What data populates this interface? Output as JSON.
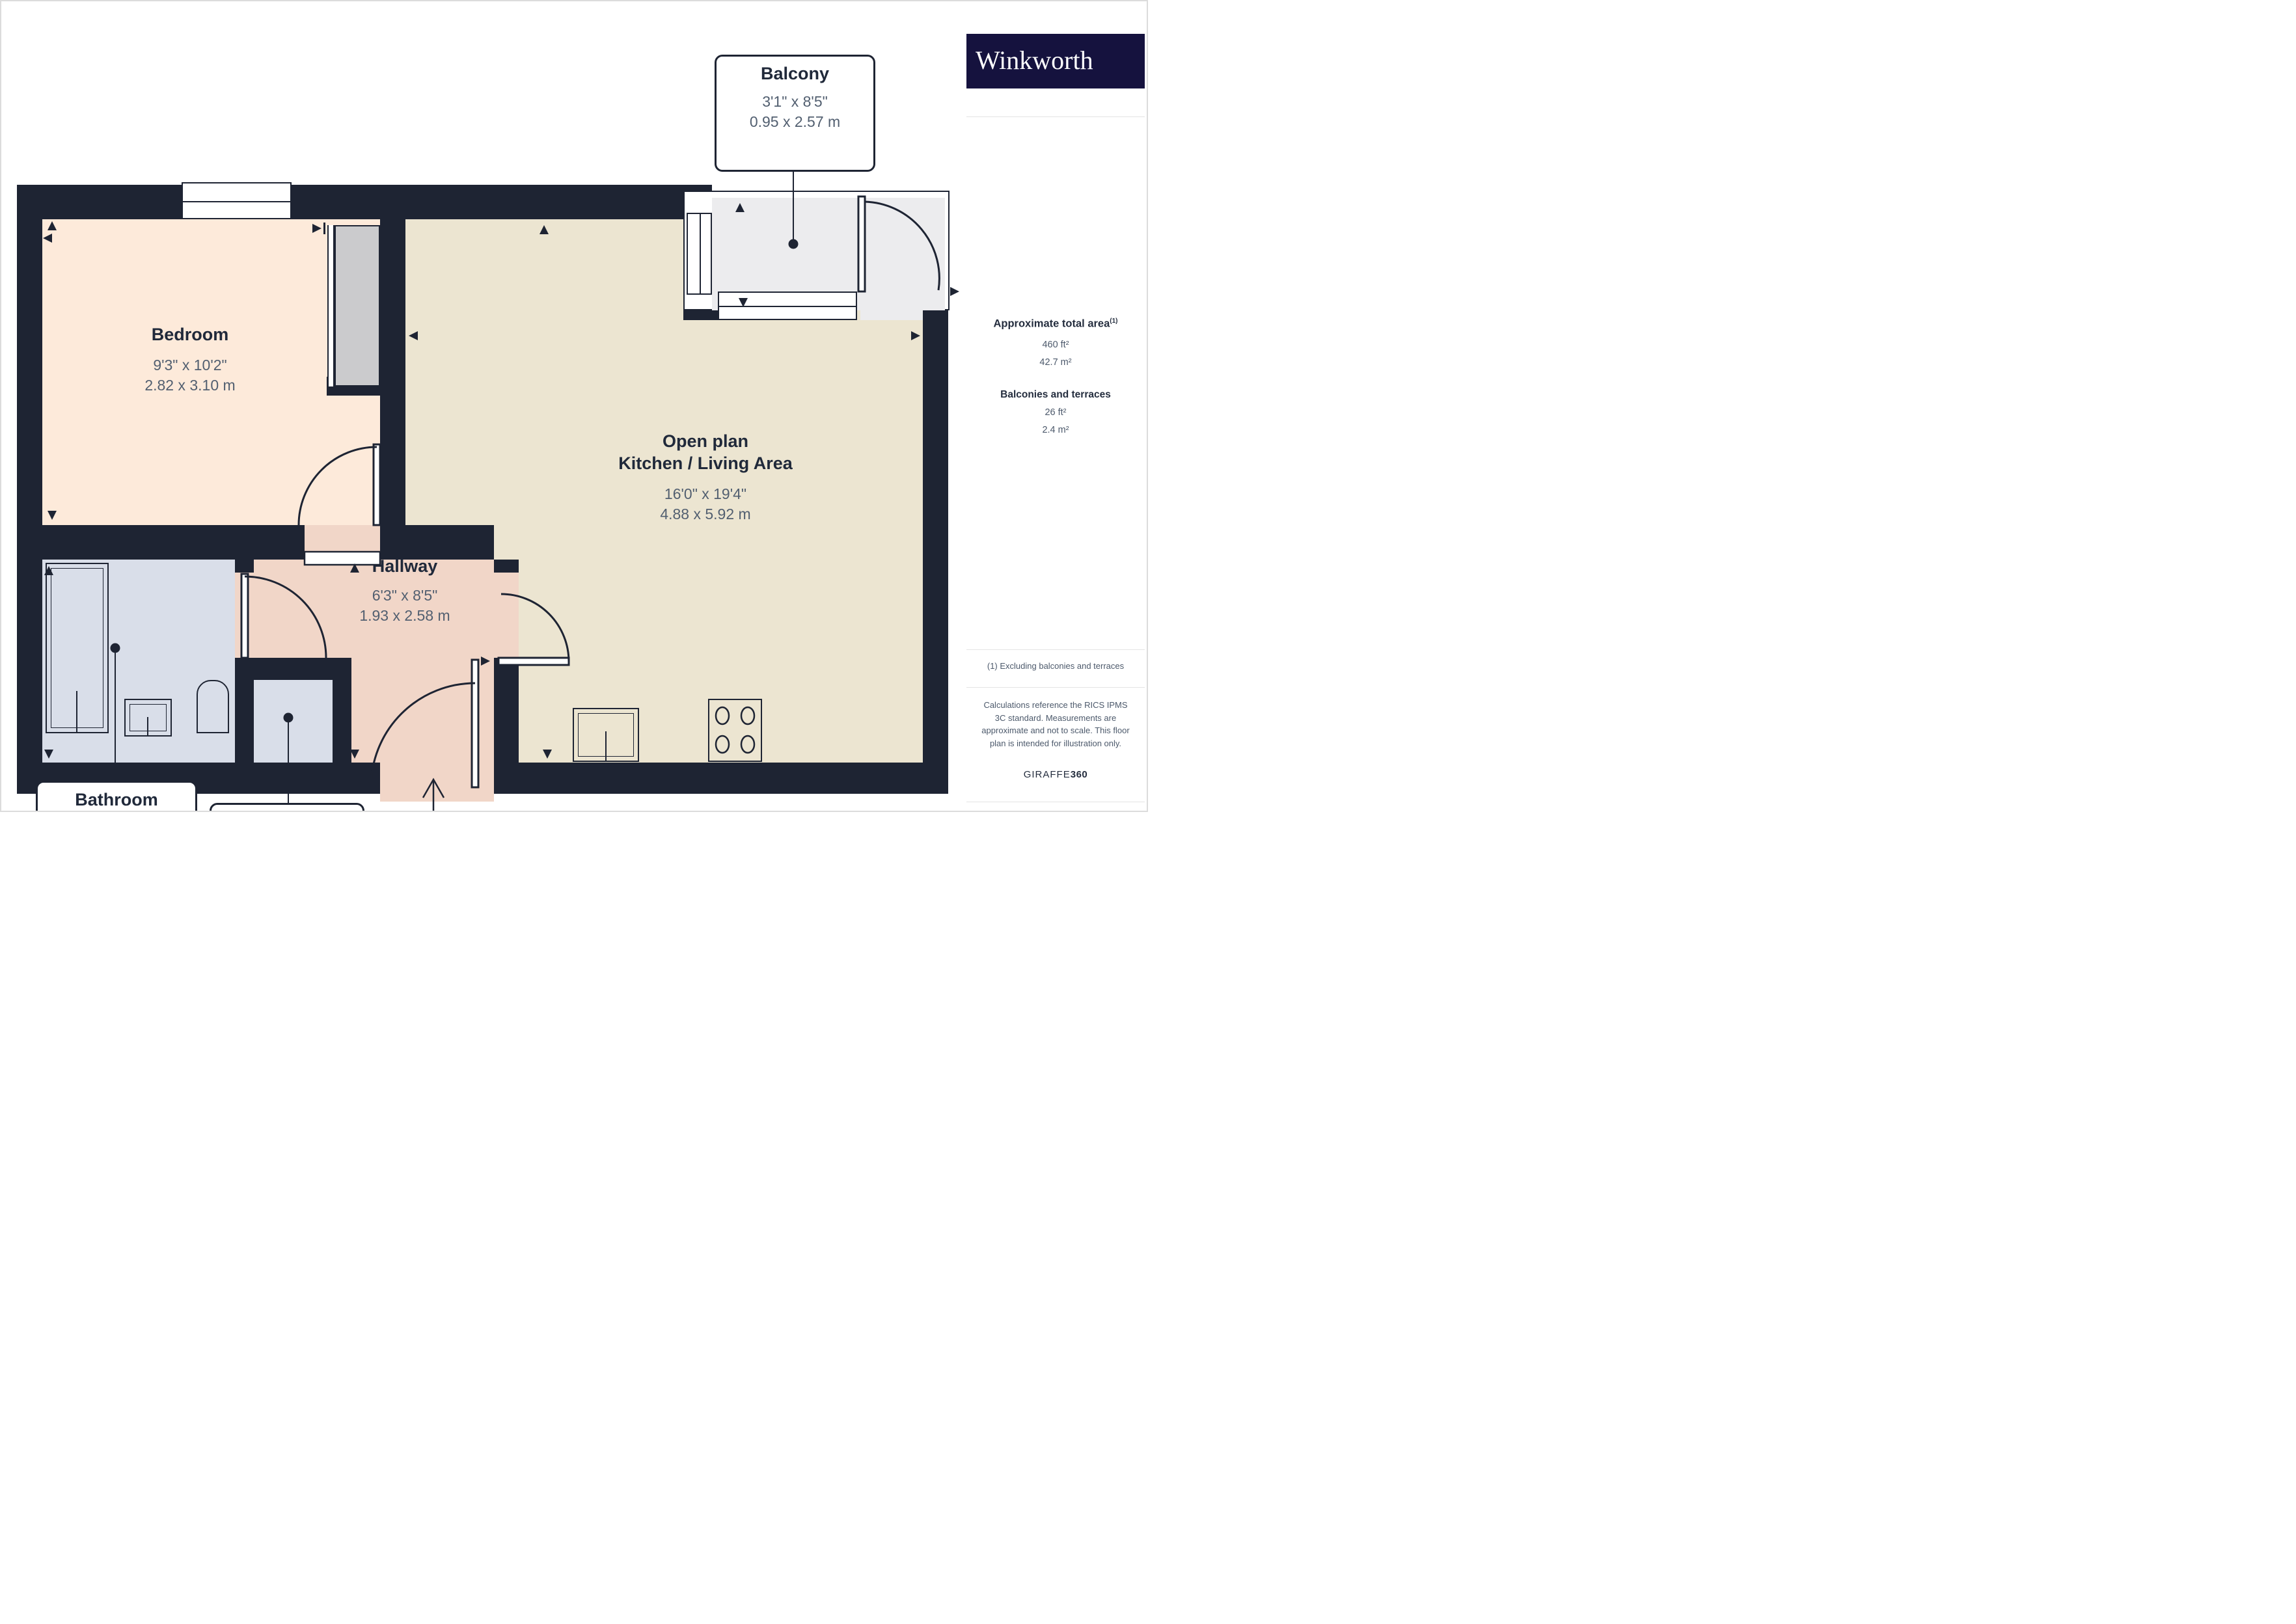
{
  "plan": {
    "rooms": {
      "bedroom": {
        "name": "Bedroom",
        "imperial": "9'3\" x 10'2\"",
        "metric": "2.82 x 3.10 m"
      },
      "open_plan": {
        "line1": "Open plan",
        "line2": "Kitchen / Living Area",
        "imperial": "16'0\" x 19'4\"",
        "metric": "4.88 x 5.92 m"
      },
      "hallway": {
        "name": "Hallway",
        "imperial": "6'3\" x 8'5\"",
        "metric": "1.93 x 2.58 m"
      },
      "bathroom": {
        "name": "Bathroom",
        "imperial": "5'6\" x 6'10\"",
        "metric": "1.69 x 2.10 m"
      },
      "utility": {
        "name": "Utility Room"
      },
      "balcony": {
        "name": "Balcony",
        "imperial": "3'1\" x 8'5\"",
        "metric": "0.95 x 2.57 m"
      }
    },
    "compass": {
      "n": "N",
      "e": "E",
      "s": "S",
      "w": "W"
    }
  },
  "sidebar": {
    "brand": "Winkworth",
    "area_title": "Approximate total area",
    "area_title_sup": "(1)",
    "area_ft": "460 ft²",
    "area_m": "42.7 m²",
    "balconies_title": "Balconies and terraces",
    "balconies_ft": "26 ft²",
    "balconies_m": "2.4 m²",
    "footnote": "(1) Excluding balconies and terraces",
    "disclaimer": "Calculations reference the RICS IPMS 3C standard. Measurements are approximate and not to scale. This floor plan is intended for illustration only.",
    "brand2_a": "GIRAFFE",
    "brand2_b": "360"
  },
  "colors": {
    "wall": "#1e2433",
    "bedroom_floor": "#fdeada",
    "kitchen_floor": "#ece5d1",
    "hallway_floor": "#f1d6c8",
    "bathroom_floor": "#d9dee9",
    "balcony_floor": "#ececee",
    "closet": "#cbcbcd",
    "room_name_text": "#20293a",
    "dimension_text": "#525f70",
    "logo_background": "#15123e"
  }
}
